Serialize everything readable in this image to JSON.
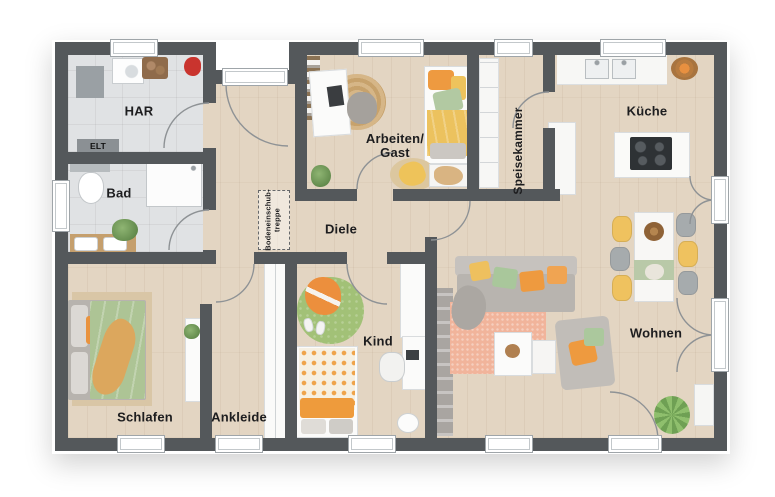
{
  "rooms": {
    "har": {
      "label": "HAR"
    },
    "elt": {
      "label": "ELT"
    },
    "bad": {
      "label": "Bad"
    },
    "schlafen": {
      "label": "Schlafen"
    },
    "ankleide": {
      "label": "Ankleide"
    },
    "kind": {
      "label": "Kind"
    },
    "diele": {
      "label": "Diele"
    },
    "arbeiten_gast": {
      "line1": "Arbeiten/",
      "line2": "Gast"
    },
    "speisekammer": {
      "label": "Speisekammer"
    },
    "kueche": {
      "label": "Küche"
    },
    "wohnen": {
      "label": "Wohnen"
    }
  },
  "annotations": {
    "attic_stairs": {
      "line1": "Bodeneinschub-",
      "line2": "treppe"
    }
  },
  "colors": {
    "wall": "#54585b",
    "wood_floor": "#e3d5c2",
    "tile_floor": "#e0e2e4",
    "accent_orange": "#ee9a3f",
    "accent_yellow": "#efc25f",
    "accent_green": "#a9c79b",
    "rug_salmon": "#f1b49b",
    "rug_green": "#a2c177",
    "jute": "#d3b284"
  }
}
